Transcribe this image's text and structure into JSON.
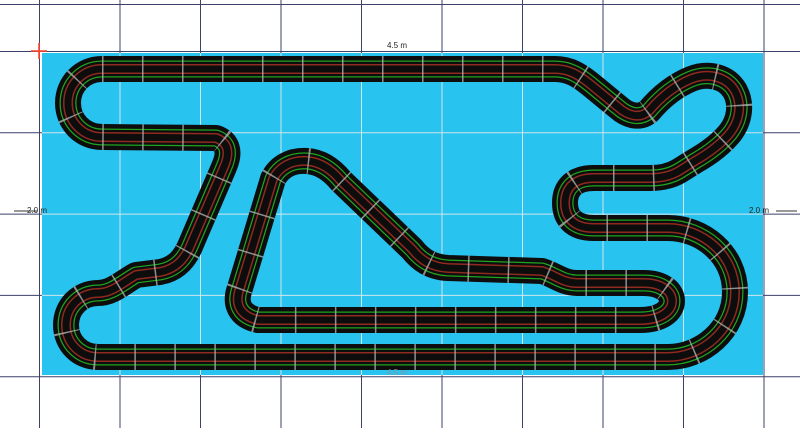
{
  "board": {
    "dimension_labels": {
      "top": "4.5 m",
      "bottom": "4.5 m",
      "left": "2.0 m",
      "right": "2.0 m"
    }
  },
  "colors": {
    "page_background": "#ffffff",
    "board_cyan": "#29C3EF",
    "grid_dark": "#3C4168",
    "grid_light": "#CFE6ED",
    "track_black": "#0D0D0D",
    "lane_outer_green": "#1FA51F",
    "lane_inner_red": "#8F2A20",
    "joint_tick": "#AAB0B0",
    "origin_cross_red": "#FF4632",
    "dimension_line": "#333333"
  }
}
